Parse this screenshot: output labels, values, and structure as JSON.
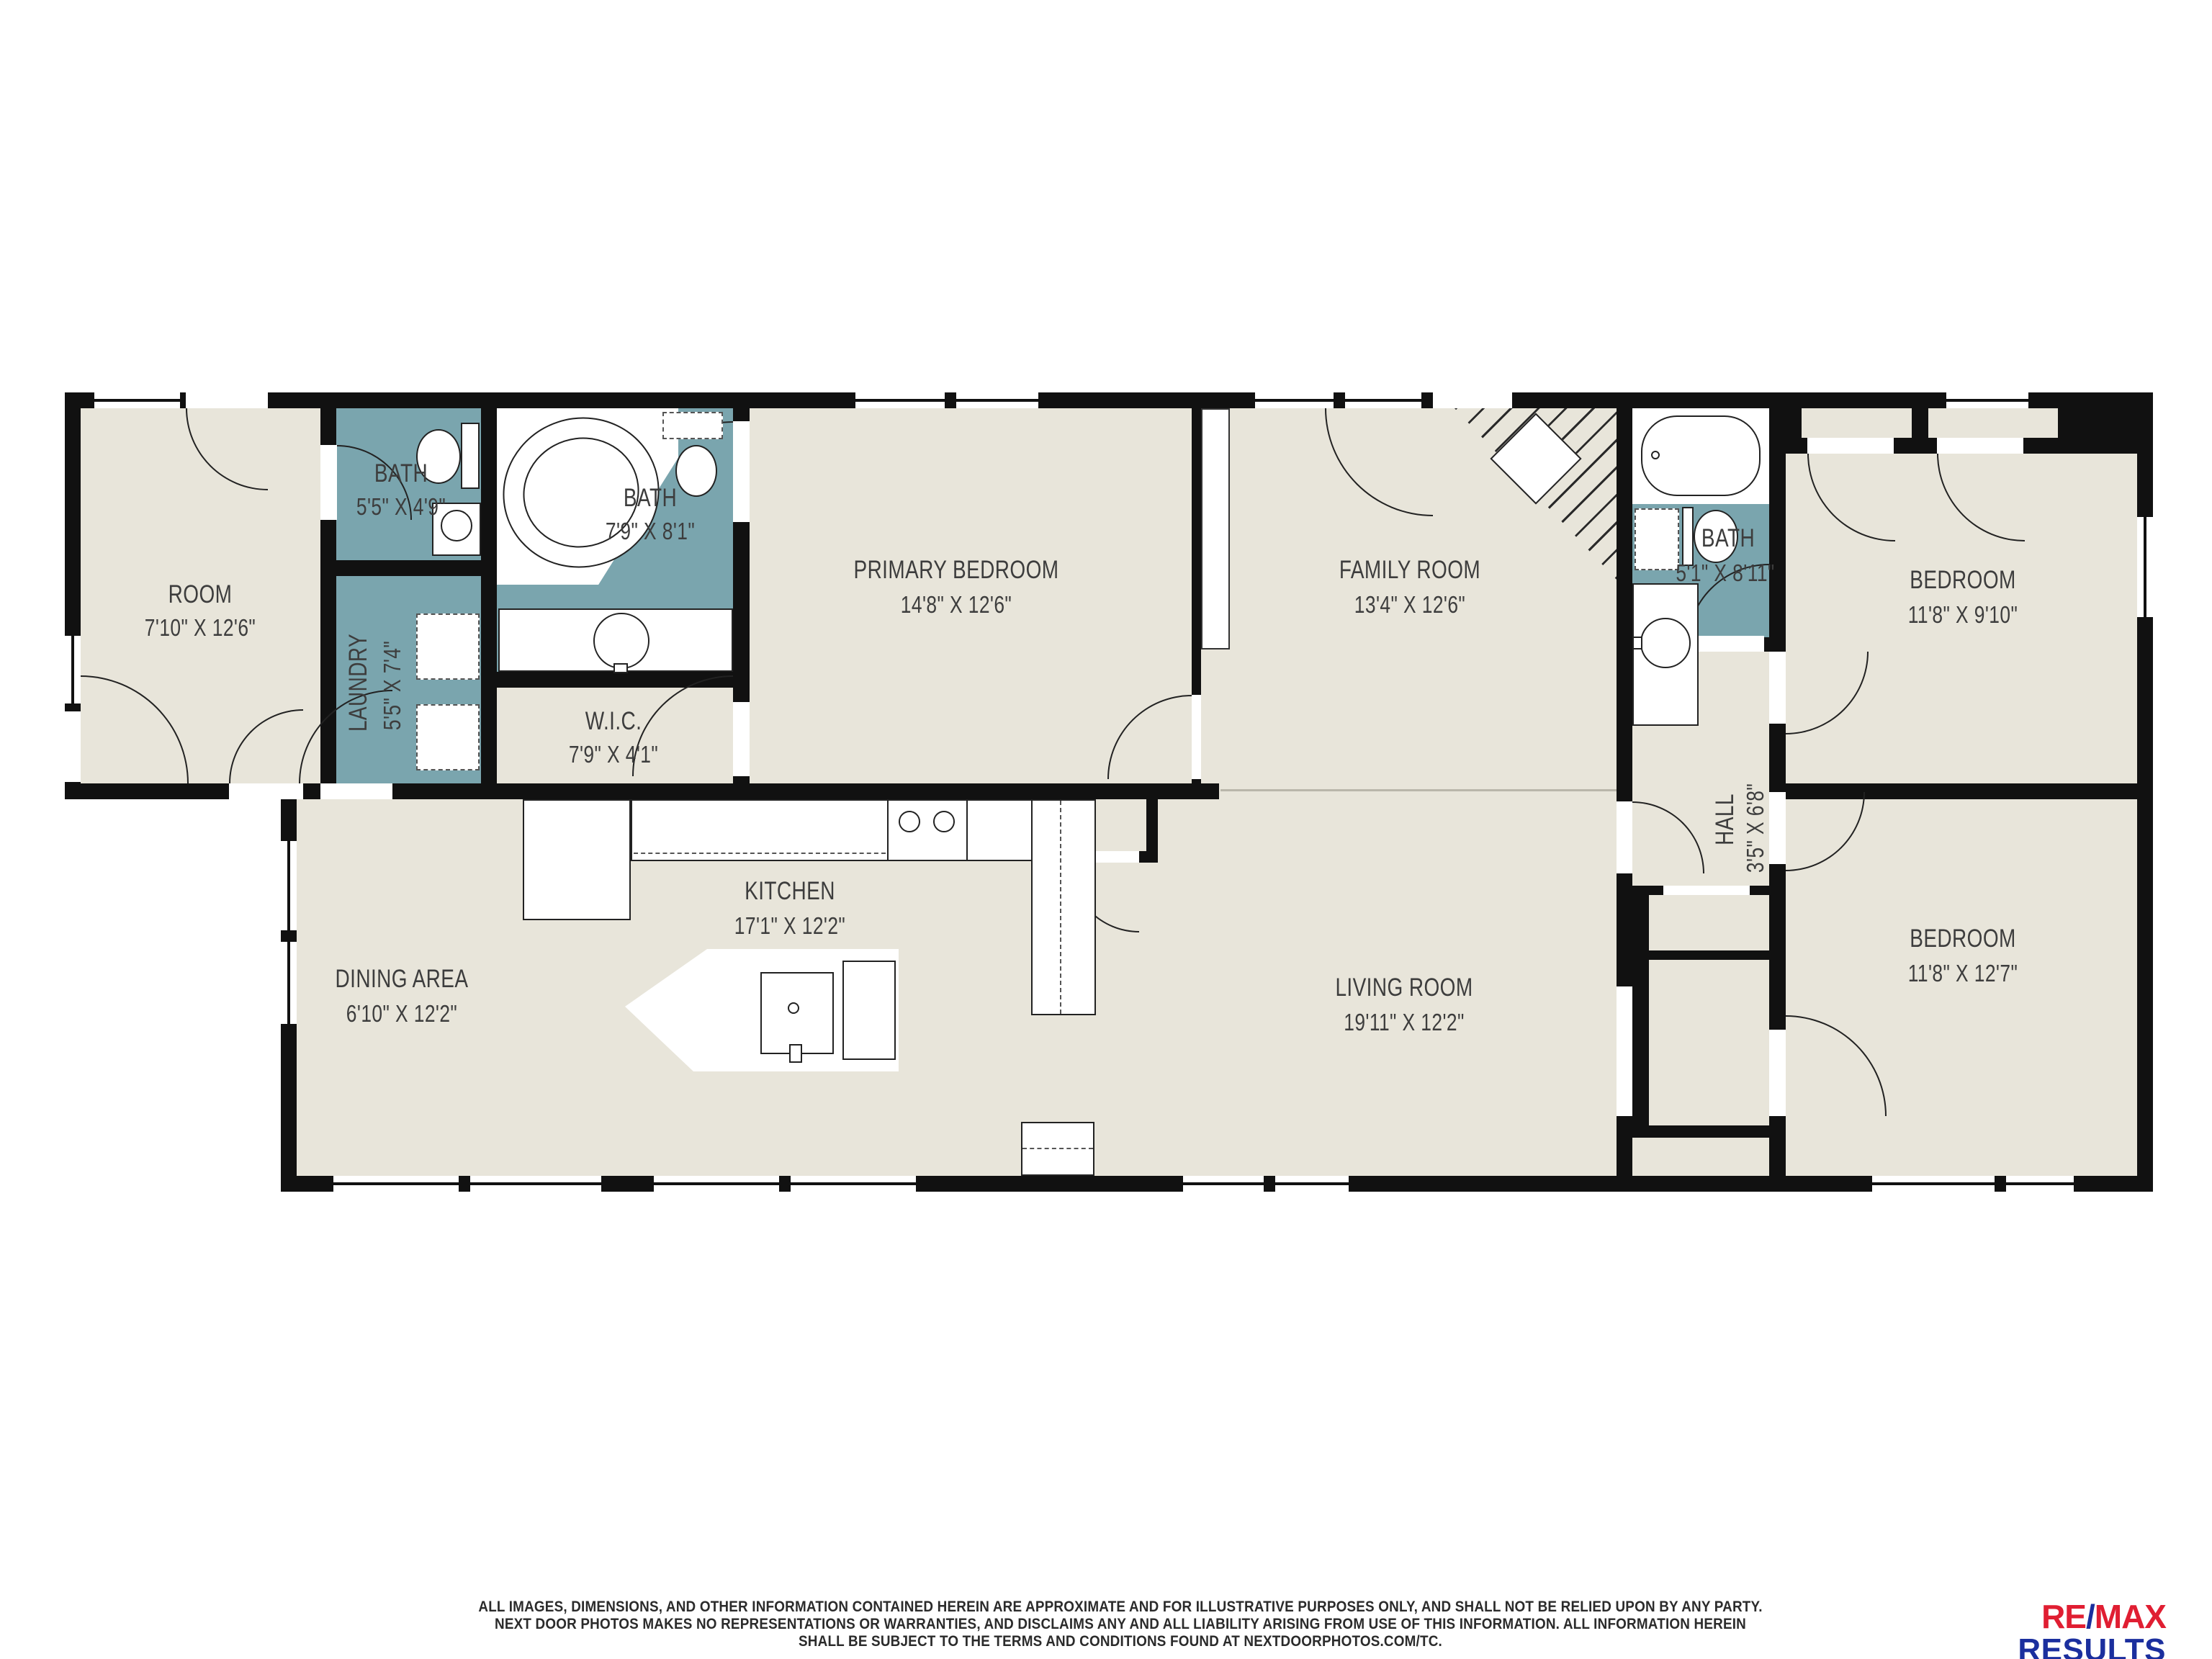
{
  "colors": {
    "wall": "#111111",
    "floor": "#e8e5da",
    "wet_room": "#7aa5ae",
    "label": "#3d3d3d",
    "remax_red": "#e01e32",
    "remax_blue": "#1b2f9e"
  },
  "rooms": {
    "flex": {
      "name": "ROOM",
      "dims": "7'10\" X 12'6\""
    },
    "bath1": {
      "name": "BATH",
      "dims": "5'5\" X 4'9\""
    },
    "laundry": {
      "name": "LAUNDRY",
      "dims": "5'5\" X 7'4\""
    },
    "bath2": {
      "name": "BATH",
      "dims": "7'9\" X 8'1\""
    },
    "wic": {
      "name": "W.I.C.",
      "dims": "7'9\" X 4'1\""
    },
    "primary": {
      "name": "PRIMARY BEDROOM",
      "dims": "14'8\" X 12'6\""
    },
    "family": {
      "name": "FAMILY ROOM",
      "dims": "13'4\" X 12'6\""
    },
    "bath3": {
      "name": "BATH",
      "dims": "5'1\" X 8'11\""
    },
    "bedroom_tr": {
      "name": "BEDROOM",
      "dims": "11'8\" X 9'10\""
    },
    "hall": {
      "name": "HALL",
      "dims": "3'5\" X 6'8\""
    },
    "kitchen": {
      "name": "KITCHEN",
      "dims": "17'1\" X 12'2\""
    },
    "dining": {
      "name": "DINING AREA",
      "dims": "6'10\" X 12'2\""
    },
    "living": {
      "name": "LIVING ROOM",
      "dims": "19'11\" X 12'2\""
    },
    "bedroom_br": {
      "name": "BEDROOM",
      "dims": "11'8\" X 12'7\""
    }
  },
  "fixtures": [
    "corner-tub",
    "bathtub",
    "toilet",
    "sink-vanity",
    "washer-dryer",
    "refrigerator",
    "range-burners",
    "kitchen-island",
    "island-sink",
    "pantry",
    "fireplace-hatch",
    "pocket-opening",
    "door-swing",
    "window"
  ],
  "footer": {
    "disclaimer_lines": [
      "ALL IMAGES, DIMENSIONS, AND OTHER INFORMATION CONTAINED HEREIN ARE APPROXIMATE AND FOR ILLUSTRATIVE PURPOSES ONLY, AND SHALL NOT BE RELIED UPON BY ANY PARTY.",
      "NEXT DOOR PHOTOS MAKES NO REPRESENTATIONS OR WARRANTIES, AND DISCLAIMS ANY AND ALL LIABILITY ARISING FROM USE OF THIS INFORMATION. ALL INFORMATION HEREIN",
      "SHALL BE SUBJECT TO THE TERMS AND CONDITIONS FOUND AT NEXTDOORPHOTOS.COM/TC."
    ]
  },
  "logo": {
    "re": "RE",
    "slash": "/",
    "max": "MAX",
    "line2": "RESULTS"
  }
}
